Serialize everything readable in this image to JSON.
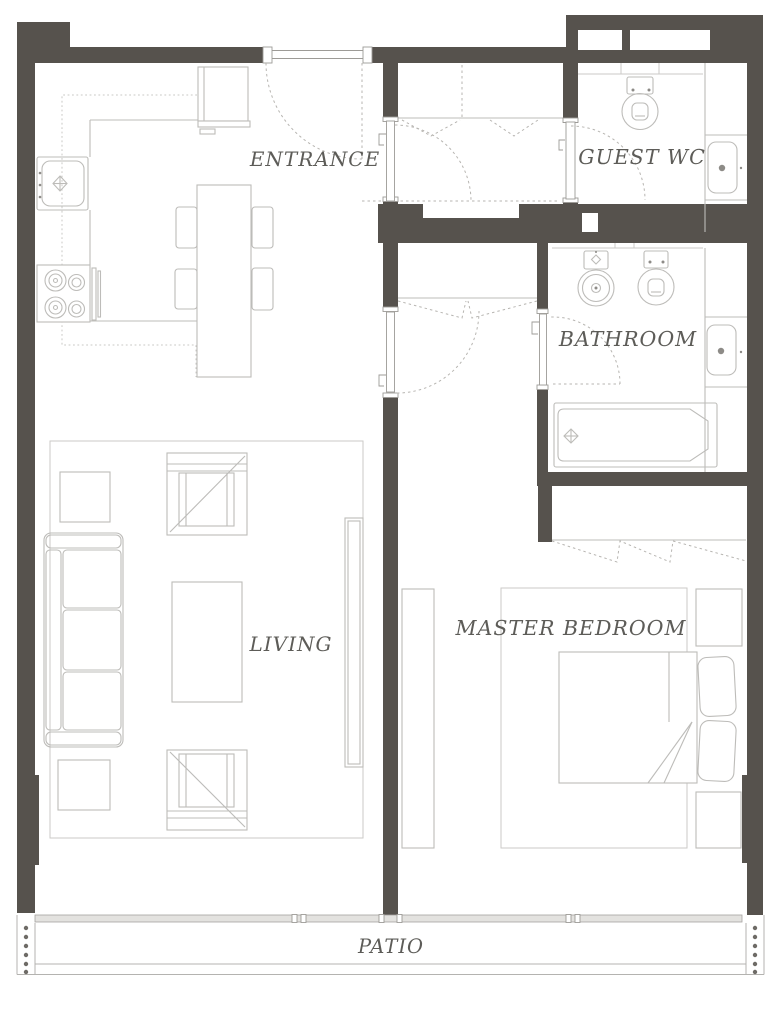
{
  "floor_plan": {
    "rooms": {
      "entrance": {
        "label": "ENTRANCE"
      },
      "guest_wc": {
        "label": "GUEST WC"
      },
      "bathroom": {
        "label": "BATHROOM"
      },
      "living": {
        "label": "LIVING"
      },
      "master_bedroom": {
        "label": "MASTER BEDROOM"
      },
      "patio": {
        "label": "PATIO"
      }
    },
    "colors": {
      "background": "#ffffff",
      "wall": "#56524d",
      "furniture_line": "#bdbcb9",
      "rug_line": "#cbcac7",
      "door_swing_line": "#b7b5b1",
      "frame_line": "#9d9b97",
      "label_text": "#5d5c58",
      "railing_dot": "#6e6b66",
      "track_fill": "#e3e2df"
    },
    "fixtures": {
      "kitchen": [
        "refrigerator",
        "kitchen-counter",
        "overhead-cabinets",
        "kitchen-sink",
        "cooktop",
        "oven-handle",
        "dining-table",
        "dining-chair"
      ],
      "living": [
        "rug",
        "sofa",
        "armchair",
        "coffee-table",
        "side-table",
        "tv-console"
      ],
      "hall": [
        "entrance-door",
        "hall-closet",
        "bifold-doors",
        "hinged-door",
        "door-swing-arc"
      ],
      "guest_wc": [
        "toilet",
        "vanity-washbasin",
        "shelf"
      ],
      "bathroom": [
        "bidet",
        "toilet",
        "vanity-washbasin",
        "bathtub",
        "shelf"
      ],
      "master_bedroom": [
        "rug",
        "double-bed",
        "pillow",
        "nightstand",
        "dresser",
        "closet-bifold"
      ],
      "patio": [
        "sliding-glass-door",
        "patio-railing"
      ]
    }
  }
}
